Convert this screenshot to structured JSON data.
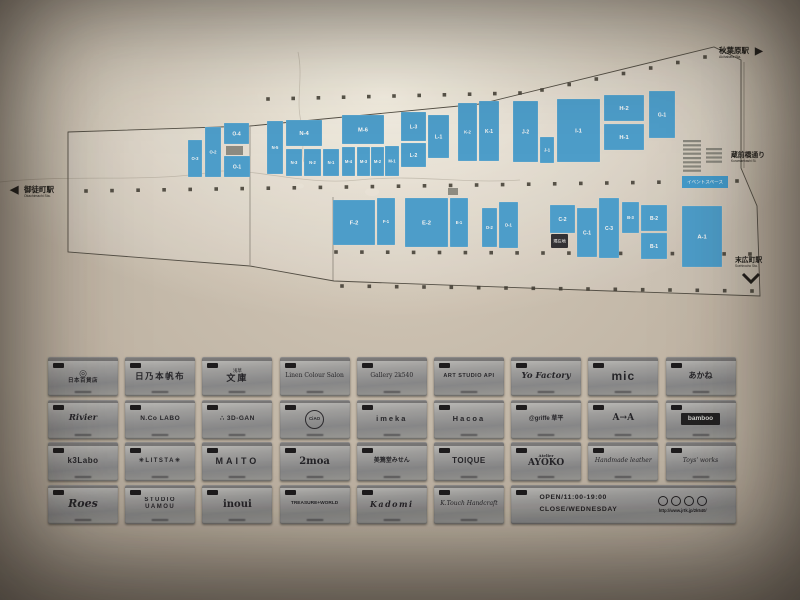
{
  "photo": {
    "map": {
      "stations": {
        "left": {
          "jp": "御徒町駅",
          "en": "Okachimachi Sta.",
          "arrow": "◀"
        },
        "top_right": {
          "jp": "秋葉原駅",
          "en": "Akihabara Sta.",
          "arrow": "▶"
        },
        "right_street": {
          "jp": "蔵前橋通り",
          "en": "Kuramaebashi St."
        },
        "bottom_right": {
          "jp": "末広町駅",
          "en": "Suehirocho Sta."
        }
      },
      "event_space_label": "イベントスペース",
      "you_are_here": "現在地",
      "outline": "68,132 250,126 480,104 714,47 741,60 741,168 757,206 760,296 610,291 334,281 250,266 68,252",
      "inner_lines": [
        [
          333,
          197,
          333,
          281
        ],
        [
          250,
          127,
          250,
          265
        ],
        [
          744,
          62,
          744,
          168
        ]
      ],
      "units": [
        {
          "label": "O-3",
          "x": 188,
          "y": 140,
          "w": 14,
          "h": 37
        },
        {
          "label": "O-2",
          "x": 205,
          "y": 127,
          "w": 16,
          "h": 50
        },
        {
          "label": "O-4",
          "x": 224,
          "y": 123,
          "w": 25,
          "h": 21
        },
        {
          "label": "O-1",
          "x": 224,
          "y": 156,
          "w": 26,
          "h": 21
        },
        {
          "label": "N-5",
          "x": 267,
          "y": 121,
          "w": 16,
          "h": 53
        },
        {
          "label": "N-4",
          "x": 286,
          "y": 120,
          "w": 36,
          "h": 26
        },
        {
          "label": "N-3",
          "x": 286,
          "y": 149,
          "w": 16,
          "h": 27
        },
        {
          "label": "N-2",
          "x": 304,
          "y": 149,
          "w": 17,
          "h": 27
        },
        {
          "label": "N-1",
          "x": 323,
          "y": 149,
          "w": 16,
          "h": 27
        },
        {
          "label": "M-6",
          "x": 342,
          "y": 115,
          "w": 42,
          "h": 29
        },
        {
          "label": "M-4",
          "x": 342,
          "y": 147,
          "w": 13,
          "h": 29
        },
        {
          "label": "M-3",
          "x": 357,
          "y": 147,
          "w": 13,
          "h": 29
        },
        {
          "label": "M-2",
          "x": 371,
          "y": 147,
          "w": 13,
          "h": 29
        },
        {
          "label": "M-1",
          "x": 385,
          "y": 146,
          "w": 14,
          "h": 30
        },
        {
          "label": "L-3",
          "x": 401,
          "y": 112,
          "w": 25,
          "h": 29
        },
        {
          "label": "L-2",
          "x": 401,
          "y": 143,
          "w": 25,
          "h": 24
        },
        {
          "label": "L-1",
          "x": 428,
          "y": 115,
          "w": 21,
          "h": 43
        },
        {
          "label": "K-2",
          "x": 458,
          "y": 103,
          "w": 19,
          "h": 58
        },
        {
          "label": "K-1",
          "x": 479,
          "y": 101,
          "w": 20,
          "h": 60
        },
        {
          "label": "J-2",
          "x": 513,
          "y": 101,
          "w": 25,
          "h": 61
        },
        {
          "label": "J-1",
          "x": 540,
          "y": 137,
          "w": 14,
          "h": 26
        },
        {
          "label": "I-1",
          "x": 557,
          "y": 99,
          "w": 43,
          "h": 63
        },
        {
          "label": "H-2",
          "x": 604,
          "y": 95,
          "w": 40,
          "h": 26
        },
        {
          "label": "H-1",
          "x": 604,
          "y": 124,
          "w": 40,
          "h": 26
        },
        {
          "label": "G-1",
          "x": 649,
          "y": 91,
          "w": 26,
          "h": 47
        },
        {
          "label": "F-2",
          "x": 333,
          "y": 200,
          "w": 42,
          "h": 45
        },
        {
          "label": "F-1",
          "x": 377,
          "y": 198,
          "w": 18,
          "h": 47
        },
        {
          "label": "E-2",
          "x": 405,
          "y": 198,
          "w": 43,
          "h": 49
        },
        {
          "label": "E-1",
          "x": 450,
          "y": 198,
          "w": 18,
          "h": 49
        },
        {
          "label": "D-2",
          "x": 482,
          "y": 208,
          "w": 15,
          "h": 39
        },
        {
          "label": "D-1",
          "x": 499,
          "y": 202,
          "w": 19,
          "h": 46
        },
        {
          "label": "C-2",
          "x": 550,
          "y": 205,
          "w": 25,
          "h": 28
        },
        {
          "label": "C-1",
          "x": 577,
          "y": 208,
          "w": 20,
          "h": 49
        },
        {
          "label": "C-3",
          "x": 599,
          "y": 198,
          "w": 20,
          "h": 60
        },
        {
          "label": "B-3",
          "x": 622,
          "y": 202,
          "w": 17,
          "h": 31
        },
        {
          "label": "B-2",
          "x": 641,
          "y": 205,
          "w": 26,
          "h": 26
        },
        {
          "label": "B-1",
          "x": 641,
          "y": 233,
          "w": 26,
          "h": 26
        },
        {
          "label": "A-1",
          "x": 682,
          "y": 206,
          "w": 40,
          "h": 61
        }
      ],
      "gray_blocks": [
        {
          "x": 226,
          "y": 146,
          "w": 17,
          "h": 9
        },
        {
          "x": 448,
          "y": 188,
          "w": 10,
          "h": 7
        }
      ],
      "stairs": [
        {
          "x": 683,
          "y": 140,
          "w": 18
        },
        {
          "x": 683,
          "y": 157,
          "w": 18
        },
        {
          "x": 706,
          "y": 148,
          "w": 16
        }
      ],
      "pillar_rows": [
        {
          "x0": 268,
          "y0": 99,
          "x1": 520,
          "y1": 93,
          "n": 11
        },
        {
          "x0": 542,
          "y0": 90,
          "x1": 705,
          "y1": 57,
          "n": 7
        },
        {
          "x0": 86,
          "y0": 191,
          "x1": 737,
          "y1": 181,
          "n": 26
        },
        {
          "x0": 336,
          "y0": 252,
          "x1": 750,
          "y1": 254,
          "n": 17
        },
        {
          "x0": 342,
          "y0": 286,
          "x1": 752,
          "y1": 291,
          "n": 16
        }
      ],
      "banner": {
        "x": 682,
        "y": 176,
        "w": 46,
        "h": 12
      },
      "marker": {
        "x": 551,
        "y": 234,
        "w": 17,
        "h": 14
      },
      "colors": {
        "unit": "#4aa2d3",
        "line": "#514e45",
        "dot": "#3a372f",
        "banner": "#3f9fd4",
        "marker": "#2e2e33"
      }
    },
    "directory": {
      "rows": [
        [
          {
            "main": "日本百貨店",
            "top": "◎",
            "cls": "c-mark"
          },
          {
            "main": "日乃本帆布",
            "cls": "c-kanji-lg"
          },
          {
            "main": "文庫",
            "top": "浅草",
            "cls": "c-bunko"
          },
          {
            "main": "Linen Colour Salon",
            "cls": "c-serif-sm"
          },
          {
            "main": "Gallery 2k540",
            "cls": "c-serif-sm"
          },
          {
            "main": "ART STUDIO API",
            "cls": "c-sans-xs"
          },
          {
            "main": "Yo Factory",
            "cls": "c-script"
          },
          {
            "main": "mic",
            "cls": "c-bold-xl"
          },
          {
            "main": "あかね",
            "cls": "c-kanji-bold"
          }
        ],
        [
          {
            "main": "Rivier",
            "cls": "c-script"
          },
          {
            "main": "N.Co LABO",
            "cls": "c-sans-sm"
          },
          {
            "main": "∴ 3D-GAN",
            "cls": "c-sans-sm"
          },
          {
            "main": "CiAO",
            "cls": "c-circle"
          },
          {
            "main": "imeka",
            "cls": "c-sans-md-sp"
          },
          {
            "main": "Hacoa",
            "cls": "c-sans-md-sp"
          },
          {
            "main": "@griffe 草平",
            "cls": "c-mixed-sm"
          },
          {
            "main": "A→A",
            "cls": "c-serif-md"
          },
          {
            "main": "bamboo",
            "cls": "c-darkbox"
          }
        ],
        [
          {
            "main": "k3Labo",
            "cls": "c-bold-md"
          },
          {
            "main": "✳LITSTA✳",
            "cls": "c-sans-sm-sp"
          },
          {
            "main": "MAITO",
            "cls": "c-sans-lg-sp"
          },
          {
            "main": "2moa",
            "cls": "c-serif-lg"
          },
          {
            "main": "美篶堂みせん",
            "cls": "c-kanji-md"
          },
          {
            "main": "TOIQUE",
            "cls": "c-bold-md"
          },
          {
            "main": "AYOKO",
            "top": "Atelier",
            "cls": "c-serif-md"
          },
          {
            "main": "Handmade leather",
            "cls": "c-script-sm"
          },
          {
            "main": "Toys' works",
            "cls": "c-script-sm"
          }
        ],
        [
          {
            "main": "Roes",
            "cls": "c-script-lg"
          },
          {
            "main": "STUDIO UAMOU",
            "cls": "c-sans-sm-sp"
          },
          {
            "main": "inoui",
            "cls": "c-serif-lg"
          },
          {
            "main": "TREASURE+WORLD",
            "cls": "c-sans-xxs"
          },
          {
            "main": "Kadomi",
            "cls": "c-script-md"
          },
          {
            "main": "K.Touch Handcraft",
            "cls": "c-script-sm"
          }
        ]
      ],
      "info_plate": {
        "open": "OPEN/11:00-19:00",
        "close": "CLOSE/WEDNESDAY",
        "url": "http://www.jrtk.jp/2k540/"
      }
    }
  }
}
